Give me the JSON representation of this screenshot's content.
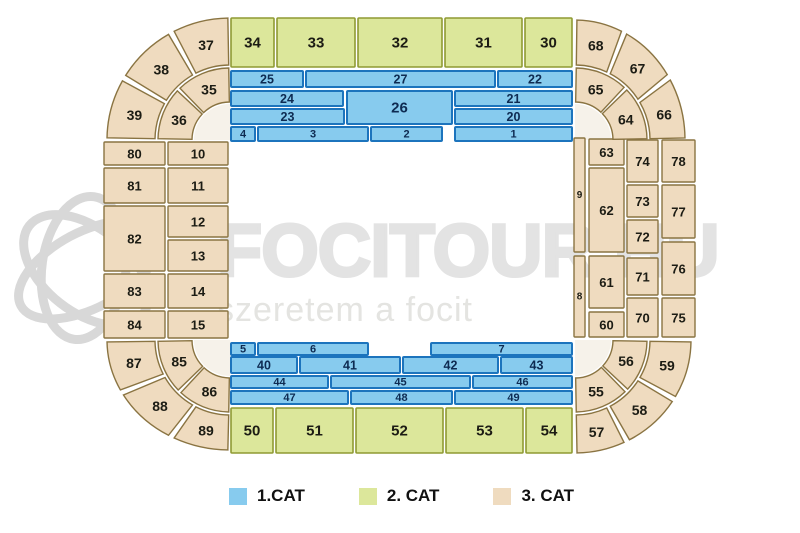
{
  "page": {
    "type": "stadium-seating-chart"
  },
  "watermark": {
    "brand": "FOCITOUR.HU",
    "tagline": "szeretem a focit",
    "logo_icon": "soccer-ball-swirl-logo"
  },
  "legend": {
    "items": [
      {
        "label": "1.CAT",
        "cat": 1
      },
      {
        "label": "2. CAT",
        "cat": 2
      },
      {
        "label": "3. CAT",
        "cat": 3
      }
    ]
  },
  "colors": {
    "cat1_fill": "#87CBEE",
    "cat1_stroke": "#1C74BD",
    "cat1_text": "#0E2B52",
    "cat2_fill": "#DCE79B",
    "cat2_stroke": "#8F9A33",
    "cat3_fill": "#EFDBBF",
    "cat3_stroke": "#8A7442",
    "dark_text": "#1C1C14",
    "watermark_brand": "#E3E3E3",
    "watermark_tagline": "#E4E4E1",
    "watermark_logo": "#D8D8D8",
    "corner_inner": "#F6F2EA"
  },
  "sections": [
    {
      "label": "34",
      "cat": 2,
      "shape": "rect",
      "x": 231,
      "y": 18,
      "w": 43,
      "h": 49
    },
    {
      "label": "33",
      "cat": 2,
      "shape": "rect",
      "x": 277,
      "y": 18,
      "w": 78,
      "h": 49
    },
    {
      "label": "32",
      "cat": 2,
      "shape": "rect",
      "x": 358,
      "y": 18,
      "w": 84,
      "h": 49
    },
    {
      "label": "31",
      "cat": 2,
      "shape": "rect",
      "x": 445,
      "y": 18,
      "w": 77,
      "h": 49
    },
    {
      "label": "30",
      "cat": 2,
      "shape": "rect",
      "x": 525,
      "y": 18,
      "w": 47,
      "h": 49
    },
    {
      "label": "25",
      "cat": 1,
      "shape": "rect",
      "x": 231,
      "y": 71,
      "w": 72,
      "h": 16
    },
    {
      "label": "27",
      "cat": 1,
      "shape": "rect",
      "x": 306,
      "y": 71,
      "w": 189,
      "h": 16
    },
    {
      "label": "22",
      "cat": 1,
      "shape": "rect",
      "x": 498,
      "y": 71,
      "w": 74,
      "h": 16
    },
    {
      "label": "24",
      "cat": 1,
      "shape": "rect",
      "x": 231,
      "y": 91,
      "w": 112,
      "h": 15
    },
    {
      "label": "26",
      "cat": 1,
      "shape": "rect",
      "x": 347,
      "y": 91,
      "w": 105,
      "h": 33
    },
    {
      "label": "21",
      "cat": 1,
      "shape": "rect",
      "x": 455,
      "y": 91,
      "w": 117,
      "h": 15
    },
    {
      "label": "23",
      "cat": 1,
      "shape": "rect",
      "x": 231,
      "y": 109,
      "w": 113,
      "h": 15
    },
    {
      "label": "20",
      "cat": 1,
      "shape": "rect",
      "x": 455,
      "y": 109,
      "w": 117,
      "h": 15
    },
    {
      "label": "4",
      "cat": 1,
      "shape": "rect",
      "x": 231,
      "y": 127,
      "w": 24,
      "h": 14
    },
    {
      "label": "3",
      "cat": 1,
      "shape": "rect",
      "x": 258,
      "y": 127,
      "w": 110,
      "h": 14
    },
    {
      "label": "2",
      "cat": 1,
      "shape": "rect",
      "x": 371,
      "y": 127,
      "w": 71,
      "h": 14
    },
    {
      "label": "1",
      "cat": 1,
      "shape": "rect",
      "x": 455,
      "y": 127,
      "w": 117,
      "h": 14
    },
    {
      "label": "80",
      "cat": 3,
      "shape": "rect",
      "x": 104,
      "y": 142,
      "w": 61,
      "h": 23
    },
    {
      "label": "81",
      "cat": 3,
      "shape": "rect",
      "x": 104,
      "y": 168,
      "w": 61,
      "h": 35
    },
    {
      "label": "82",
      "cat": 3,
      "shape": "rect",
      "x": 104,
      "y": 206,
      "w": 61,
      "h": 65
    },
    {
      "label": "83",
      "cat": 3,
      "shape": "rect",
      "x": 104,
      "y": 274,
      "w": 61,
      "h": 34
    },
    {
      "label": "84",
      "cat": 3,
      "shape": "rect",
      "x": 104,
      "y": 311,
      "w": 61,
      "h": 27
    },
    {
      "label": "10",
      "cat": 3,
      "shape": "rect",
      "x": 168,
      "y": 142,
      "w": 60,
      "h": 23
    },
    {
      "label": "11",
      "cat": 3,
      "shape": "rect",
      "x": 168,
      "y": 168,
      "w": 60,
      "h": 35
    },
    {
      "label": "12",
      "cat": 3,
      "shape": "rect",
      "x": 168,
      "y": 206,
      "w": 60,
      "h": 31
    },
    {
      "label": "13",
      "cat": 3,
      "shape": "rect",
      "x": 168,
      "y": 240,
      "w": 60,
      "h": 31
    },
    {
      "label": "14",
      "cat": 3,
      "shape": "rect",
      "x": 168,
      "y": 274,
      "w": 60,
      "h": 34
    },
    {
      "label": "15",
      "cat": 3,
      "shape": "rect",
      "x": 168,
      "y": 311,
      "w": 60,
      "h": 27
    },
    {
      "label": "9",
      "cat": 3,
      "shape": "rect",
      "x": 574,
      "y": 138,
      "w": 11,
      "h": 114
    },
    {
      "label": "8",
      "cat": 3,
      "shape": "rect",
      "x": 574,
      "y": 256,
      "w": 11,
      "h": 81
    },
    {
      "label": "63",
      "cat": 3,
      "shape": "rect",
      "x": 589,
      "y": 139,
      "w": 35,
      "h": 26
    },
    {
      "label": "62",
      "cat": 3,
      "shape": "rect",
      "x": 589,
      "y": 168,
      "w": 35,
      "h": 84
    },
    {
      "label": "61",
      "cat": 3,
      "shape": "rect",
      "x": 589,
      "y": 256,
      "w": 35,
      "h": 52
    },
    {
      "label": "60",
      "cat": 3,
      "shape": "rect",
      "x": 589,
      "y": 312,
      "w": 35,
      "h": 25
    },
    {
      "label": "74",
      "cat": 3,
      "shape": "rect",
      "x": 627,
      "y": 140,
      "w": 31,
      "h": 42
    },
    {
      "label": "73",
      "cat": 3,
      "shape": "rect",
      "x": 627,
      "y": 185,
      "w": 31,
      "h": 32
    },
    {
      "label": "72",
      "cat": 3,
      "shape": "rect",
      "x": 627,
      "y": 220,
      "w": 31,
      "h": 33
    },
    {
      "label": "71",
      "cat": 3,
      "shape": "rect",
      "x": 627,
      "y": 258,
      "w": 31,
      "h": 37
    },
    {
      "label": "70",
      "cat": 3,
      "shape": "rect",
      "x": 627,
      "y": 298,
      "w": 31,
      "h": 39
    },
    {
      "label": "78",
      "cat": 3,
      "shape": "rect",
      "x": 662,
      "y": 140,
      "w": 33,
      "h": 42
    },
    {
      "label": "77",
      "cat": 3,
      "shape": "rect",
      "x": 662,
      "y": 185,
      "w": 33,
      "h": 53
    },
    {
      "label": "76",
      "cat": 3,
      "shape": "rect",
      "x": 662,
      "y": 242,
      "w": 33,
      "h": 53
    },
    {
      "label": "75",
      "cat": 3,
      "shape": "rect",
      "x": 662,
      "y": 298,
      "w": 33,
      "h": 39
    },
    {
      "label": "5",
      "cat": 1,
      "shape": "rect",
      "x": 231,
      "y": 343,
      "w": 24,
      "h": 12
    },
    {
      "label": "6",
      "cat": 1,
      "shape": "rect",
      "x": 258,
      "y": 343,
      "w": 110,
      "h": 12
    },
    {
      "label": "7",
      "cat": 1,
      "shape": "rect",
      "x": 431,
      "y": 343,
      "w": 141,
      "h": 12
    },
    {
      "label": "40",
      "cat": 1,
      "shape": "rect",
      "x": 231,
      "y": 357,
      "w": 66,
      "h": 16
    },
    {
      "label": "41",
      "cat": 1,
      "shape": "rect",
      "x": 300,
      "y": 357,
      "w": 100,
      "h": 16
    },
    {
      "label": "42",
      "cat": 1,
      "shape": "rect",
      "x": 403,
      "y": 357,
      "w": 95,
      "h": 16
    },
    {
      "label": "43",
      "cat": 1,
      "shape": "rect",
      "x": 501,
      "y": 357,
      "w": 71,
      "h": 16
    },
    {
      "label": "44",
      "cat": 1,
      "shape": "rect",
      "x": 231,
      "y": 376,
      "w": 97,
      "h": 12
    },
    {
      "label": "45",
      "cat": 1,
      "shape": "rect",
      "x": 331,
      "y": 376,
      "w": 139,
      "h": 12
    },
    {
      "label": "46",
      "cat": 1,
      "shape": "rect",
      "x": 473,
      "y": 376,
      "w": 99,
      "h": 12
    },
    {
      "label": "47",
      "cat": 1,
      "shape": "rect",
      "x": 231,
      "y": 391,
      "w": 117,
      "h": 13
    },
    {
      "label": "48",
      "cat": 1,
      "shape": "rect",
      "x": 351,
      "y": 391,
      "w": 101,
      "h": 13
    },
    {
      "label": "49",
      "cat": 1,
      "shape": "rect",
      "x": 455,
      "y": 391,
      "w": 117,
      "h": 13
    },
    {
      "label": "50",
      "cat": 2,
      "shape": "rect",
      "x": 231,
      "y": 408,
      "w": 42,
      "h": 45
    },
    {
      "label": "51",
      "cat": 2,
      "shape": "rect",
      "x": 276,
      "y": 408,
      "w": 77,
      "h": 45
    },
    {
      "label": "52",
      "cat": 2,
      "shape": "rect",
      "x": 356,
      "y": 408,
      "w": 87,
      "h": 45
    },
    {
      "label": "53",
      "cat": 2,
      "shape": "rect",
      "x": 446,
      "y": 408,
      "w": 77,
      "h": 45
    },
    {
      "label": "54",
      "cat": 2,
      "shape": "rect",
      "x": 526,
      "y": 408,
      "w": 46,
      "h": 45
    },
    {
      "label": "39",
      "cat": 3,
      "shape": "arc",
      "cx": 230,
      "cy": 140,
      "rx0": 75,
      "ry0": 75,
      "rx1": 123,
      "ry1": 122,
      "a0": 181,
      "a1": 209
    },
    {
      "label": "38",
      "cat": 3,
      "shape": "arc",
      "cx": 230,
      "cy": 140,
      "rx0": 75,
      "ry0": 75,
      "rx1": 123,
      "ry1": 122,
      "a0": 212,
      "a1": 240
    },
    {
      "label": "37",
      "cat": 3,
      "shape": "arc",
      "cx": 230,
      "cy": 140,
      "rx0": 75,
      "ry0": 75,
      "rx1": 123,
      "ry1": 122,
      "a0": 243,
      "a1": 269
    },
    {
      "label": "36",
      "cat": 3,
      "shape": "arc",
      "cx": 230,
      "cy": 140,
      "rx0": 38,
      "ry0": 38,
      "rx1": 72,
      "ry1": 72,
      "a0": 181,
      "a1": 223
    },
    {
      "label": "35",
      "cat": 3,
      "shape": "arc",
      "cx": 230,
      "cy": 140,
      "rx0": 38,
      "ry0": 38,
      "rx1": 72,
      "ry1": 72,
      "a0": 226,
      "a1": 269
    },
    {
      "label": "68",
      "cat": 3,
      "shape": "arc",
      "cx": 575,
      "cy": 140,
      "rx0": 75,
      "ry0": 75,
      "rx1": 110,
      "ry1": 120,
      "a0": 271,
      "a1": 295
    },
    {
      "label": "67",
      "cat": 3,
      "shape": "arc",
      "cx": 575,
      "cy": 140,
      "rx0": 75,
      "ry0": 75,
      "rx1": 110,
      "ry1": 120,
      "a0": 298,
      "a1": 327
    },
    {
      "label": "66",
      "cat": 3,
      "shape": "arc",
      "cx": 575,
      "cy": 140,
      "rx0": 75,
      "ry0": 75,
      "rx1": 110,
      "ry1": 120,
      "a0": 330,
      "a1": 359
    },
    {
      "label": "65",
      "cat": 3,
      "shape": "arc",
      "cx": 575,
      "cy": 140,
      "rx0": 38,
      "ry0": 38,
      "rx1": 72,
      "ry1": 72,
      "a0": 271,
      "a1": 313
    },
    {
      "label": "64",
      "cat": 3,
      "shape": "arc",
      "cx": 575,
      "cy": 140,
      "rx0": 38,
      "ry0": 38,
      "rx1": 72,
      "ry1": 72,
      "a0": 316,
      "a1": 359
    },
    {
      "label": "89",
      "cat": 3,
      "shape": "arc",
      "cx": 230,
      "cy": 340,
      "rx0": 75,
      "ry0": 75,
      "rx1": 123,
      "ry1": 110,
      "a0": 91,
      "a1": 117
    },
    {
      "label": "88",
      "cat": 3,
      "shape": "arc",
      "cx": 230,
      "cy": 340,
      "rx0": 75,
      "ry0": 75,
      "rx1": 123,
      "ry1": 110,
      "a0": 120,
      "a1": 150
    },
    {
      "label": "87",
      "cat": 3,
      "shape": "arc",
      "cx": 230,
      "cy": 340,
      "rx0": 75,
      "ry0": 75,
      "rx1": 123,
      "ry1": 110,
      "a0": 153,
      "a1": 179
    },
    {
      "label": "86",
      "cat": 3,
      "shape": "arc",
      "cx": 230,
      "cy": 340,
      "rx0": 38,
      "ry0": 38,
      "rx1": 72,
      "ry1": 72,
      "a0": 91,
      "a1": 133
    },
    {
      "label": "85",
      "cat": 3,
      "shape": "arc",
      "cx": 230,
      "cy": 340,
      "rx0": 38,
      "ry0": 38,
      "rx1": 72,
      "ry1": 72,
      "a0": 136,
      "a1": 179
    },
    {
      "label": "59",
      "cat": 3,
      "shape": "arc",
      "cx": 575,
      "cy": 340,
      "rx0": 75,
      "ry0": 75,
      "rx1": 116,
      "ry1": 113,
      "a0": 1,
      "a1": 30
    },
    {
      "label": "58",
      "cat": 3,
      "shape": "arc",
      "cx": 575,
      "cy": 340,
      "rx0": 75,
      "ry0": 75,
      "rx1": 116,
      "ry1": 113,
      "a0": 33,
      "a1": 62
    },
    {
      "label": "57",
      "cat": 3,
      "shape": "arc",
      "cx": 575,
      "cy": 340,
      "rx0": 75,
      "ry0": 75,
      "rx1": 116,
      "ry1": 113,
      "a0": 65,
      "a1": 89
    },
    {
      "label": "56",
      "cat": 3,
      "shape": "arc",
      "cx": 575,
      "cy": 340,
      "rx0": 38,
      "ry0": 38,
      "rx1": 72,
      "ry1": 72,
      "a0": 1,
      "a1": 43
    },
    {
      "label": "55",
      "cat": 3,
      "shape": "arc",
      "cx": 575,
      "cy": 340,
      "rx0": 38,
      "ry0": 38,
      "rx1": 72,
      "ry1": 72,
      "a0": 46,
      "a1": 89
    }
  ]
}
